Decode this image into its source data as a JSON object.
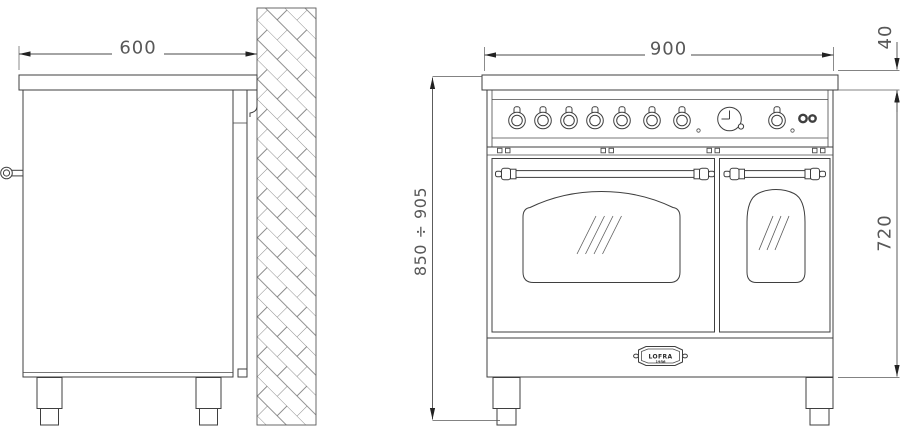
{
  "drawing": {
    "dimensions": {
      "side_depth": "600",
      "front_width": "900",
      "cooktop_height": "40",
      "overall_height_range": "850 ÷ 905",
      "body_height": "720"
    },
    "logo": {
      "brand": "LOFRA",
      "year": "1956"
    },
    "front": {
      "burner_knobs": 7,
      "oven_knobs": 1,
      "indicator_lights": 2,
      "oven_doors": 2
    }
  }
}
